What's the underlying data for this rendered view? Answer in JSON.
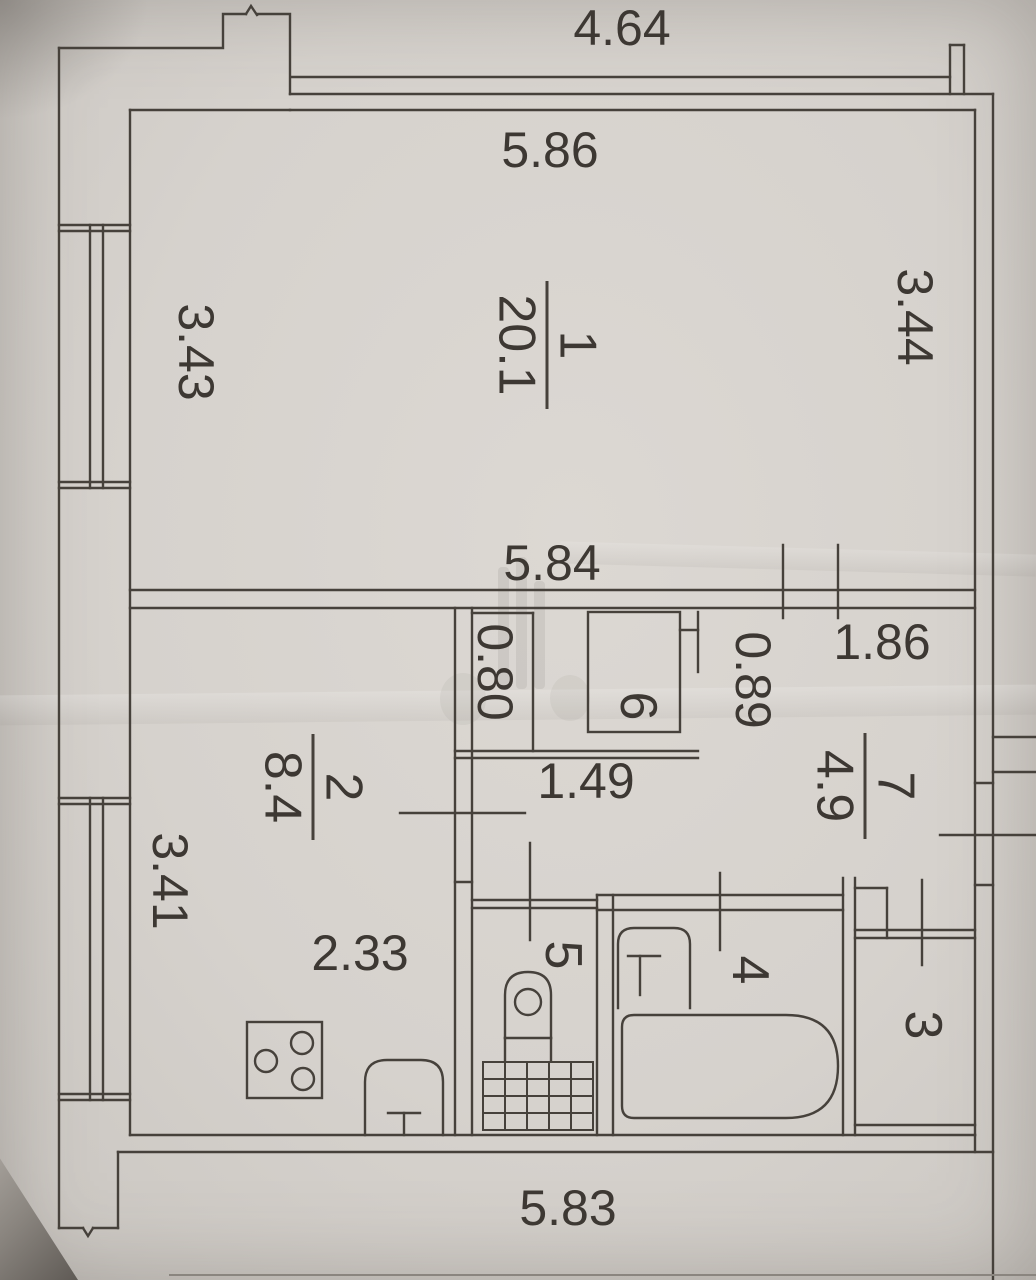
{
  "plan": {
    "title": "apartment floor plan (BTI scan)",
    "dimensions": {
      "top_offset": "4.64",
      "room1_width_top": "5.86",
      "room1_width_bottom": "5.84",
      "room1_depth_left": "3.43",
      "room1_depth_right": "3.44",
      "closet_width": "0.80",
      "closet_depth": "0.89",
      "hall_width": "1.86",
      "corridor_length": "1.49",
      "kitchen_depth_left": "3.41",
      "kitchen_width": "2.33",
      "bottom_width": "5.83"
    },
    "rooms": {
      "room1": {
        "number": "1",
        "area": "20.1"
      },
      "room2": {
        "number": "2",
        "area": "8.4"
      },
      "room3": {
        "number": "3"
      },
      "room4": {
        "number": "4"
      },
      "room5": {
        "number": "5"
      },
      "room6": {
        "number": "6"
      },
      "room7": {
        "number": "7",
        "area": "4.9"
      }
    }
  }
}
